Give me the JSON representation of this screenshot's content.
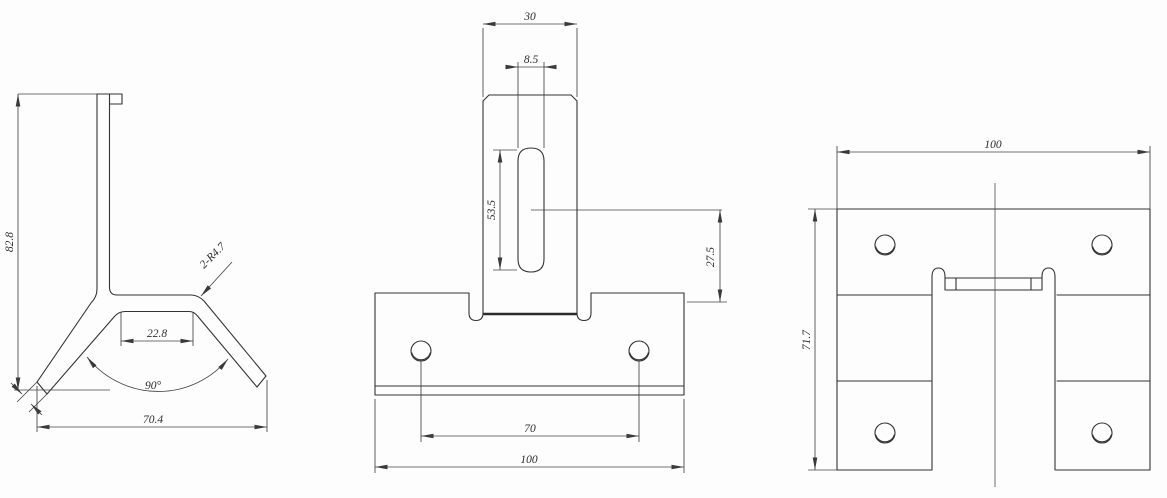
{
  "drawing": {
    "title": "sheet-metal bracket 3-view engineering drawing",
    "background": "#fdfdfd",
    "line_color": "#333333",
    "views": {
      "side": {
        "label": "side-view",
        "height": "82.8",
        "flat_width": "22.8",
        "bend_angle": "90°",
        "base_width": "70.4",
        "bend_radius_note": "2-R4.7"
      },
      "front": {
        "label": "front-view",
        "tab_width": "30",
        "slot_width": "8.5",
        "slot_length": "53.5",
        "slot_center_offset": "27.5",
        "hole_pitch": "70",
        "plate_width": "100"
      },
      "top": {
        "label": "top-view",
        "overall_width": "100",
        "overall_depth": "71.7"
      }
    }
  }
}
